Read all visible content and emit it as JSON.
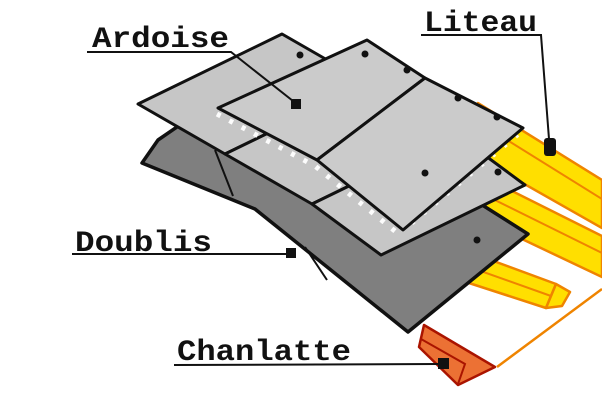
{
  "diagram": {
    "type": "roofing-slate-exploded-diagram",
    "labels": {
      "ardoise": {
        "text": "Ardoise"
      },
      "liteau": {
        "text": "Liteau"
      },
      "doublis": {
        "text": "Doublis"
      },
      "chanlatte": {
        "text": "Chanlatte"
      }
    },
    "colors": {
      "background": "#ffffff",
      "slate_gray": "#cbcbcb",
      "slate_gray_lower": "#c6c6c6",
      "doublis_gray": "#7f7f7f",
      "outline_black": "#111111",
      "batten_yellow": "#ffdf00",
      "batten_orange": "#ef8400",
      "chanlatte_fill": "#ec7134",
      "chanlatte_outline": "#aa1400",
      "deck_orange": "#ef8400"
    }
  }
}
